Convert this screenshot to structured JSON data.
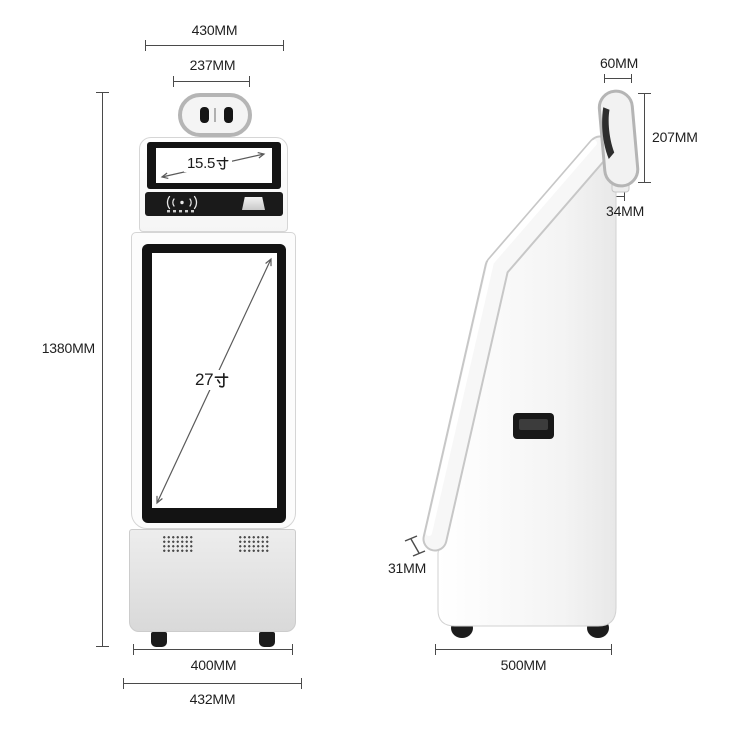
{
  "diagram": {
    "kind": "product-dimension-diagram",
    "product": "self-service-kiosk",
    "views": [
      "front",
      "side"
    ]
  },
  "front_view": {
    "dim_top_width": "430MM",
    "dim_camera_width": "237MM",
    "dim_height": "1380MM",
    "dim_feet_width": "400MM",
    "dim_base_width": "432MM",
    "top_screen": {
      "value": "15.5",
      "unit": "寸",
      "label": "15.5寸"
    },
    "main_screen": {
      "value": "27",
      "unit": "寸",
      "label": "27寸"
    }
  },
  "side_view": {
    "dim_head_width": "60MM",
    "dim_head_height": "207MM",
    "dim_mount_height": "34MM",
    "dim_screen_thickness": "31MM",
    "dim_depth": "500MM"
  },
  "icons": {
    "camera_lenses": "dual-camera-lens",
    "nfc": "nfc-contactless-icon",
    "receipt": "receipt-slot",
    "vents": "vent-grille",
    "unit_glyph": "cun-inch-character"
  },
  "colors": {
    "dimension_line": "#4a4a4a",
    "label_text": "#1f1f1f",
    "screen_bezel": "#141414",
    "device_body": "#fbfbfb",
    "device_border": "#d5d5d5",
    "base_panel": "#e3e3e3",
    "dark_details": "#1a1a1a"
  }
}
